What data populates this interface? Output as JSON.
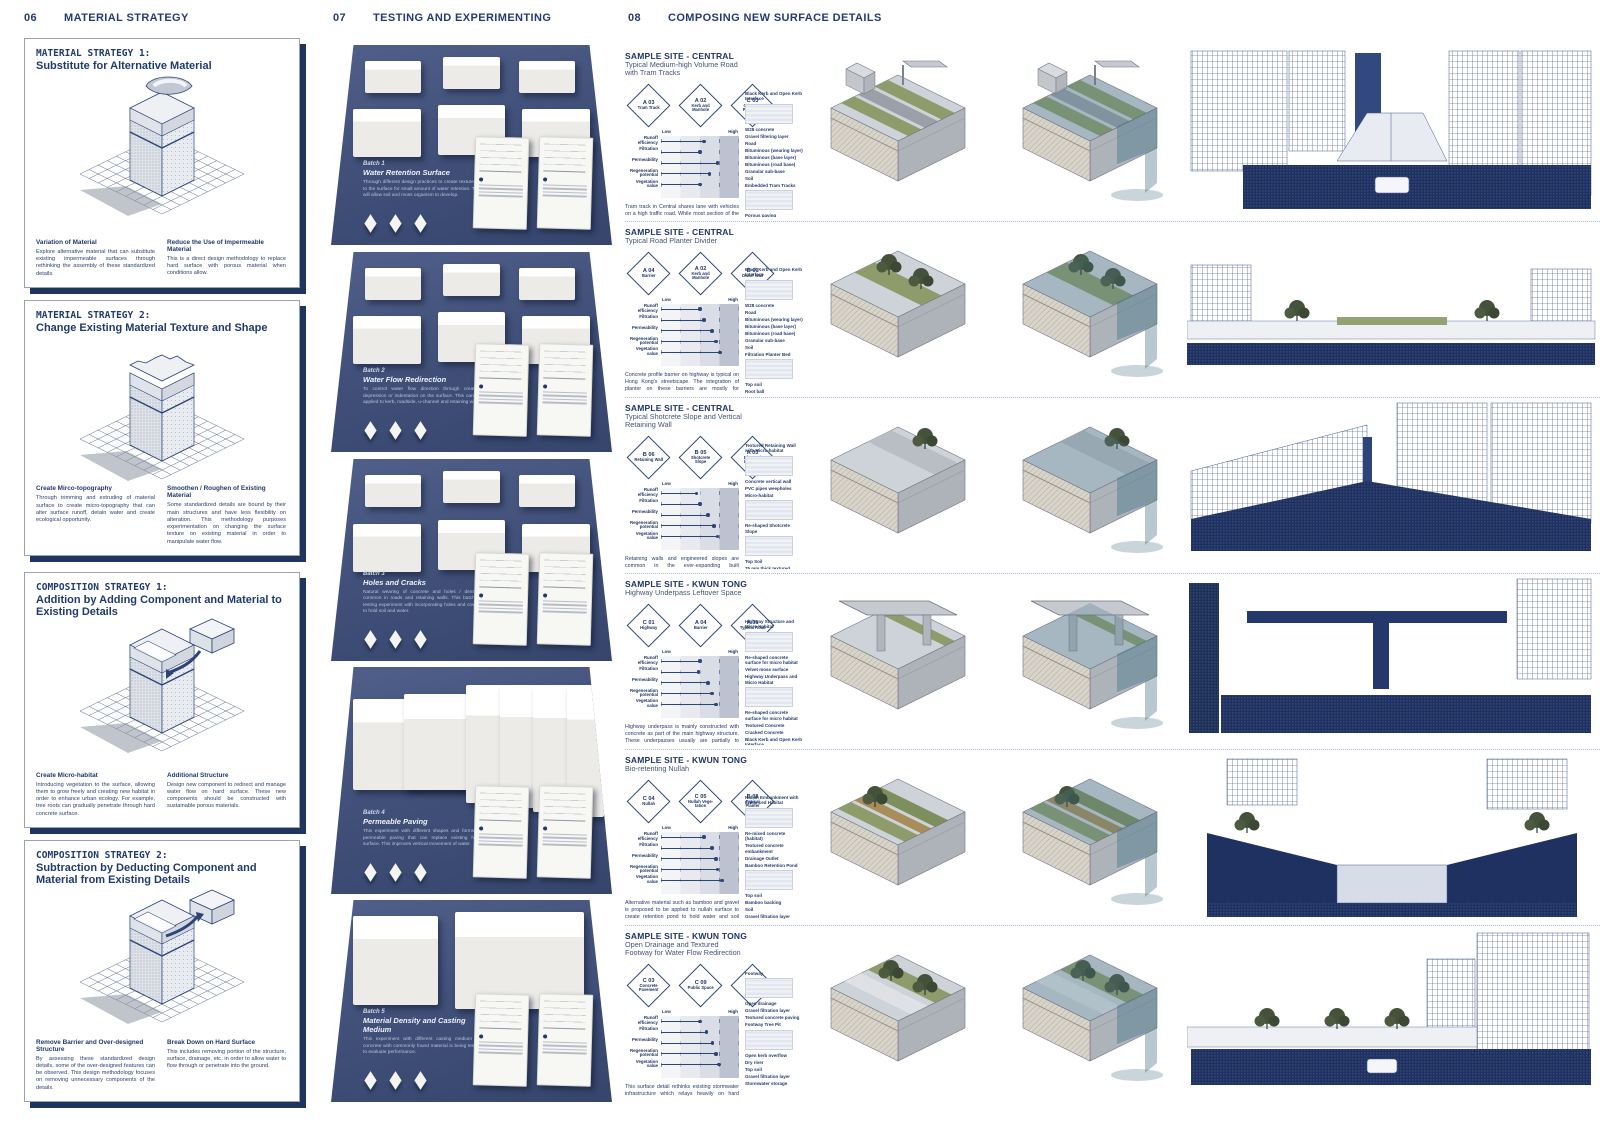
{
  "panels": [
    {
      "num": "06",
      "title": "MATERIAL STRATEGY"
    },
    {
      "num": "07",
      "title": "TESTING AND EXPERIMENTING"
    },
    {
      "num": "08",
      "title": "COMPOSING NEW SURFACE DETAILS"
    }
  ],
  "strategies": [
    {
      "kicker": "MATERIAL STRATEGY 1:",
      "title": "Substitute for Alternative Material",
      "left_heading": "Variation of Material",
      "left_body": "Explore alternative material that can substitute existing impermeable surfaces through rethinking the assembly of these standardized details.",
      "right_heading": "Reduce the Use of Impermeable Material",
      "right_body": "This is a direct design methodology to replace hard surface with porous material when conditions allow."
    },
    {
      "kicker": "MATERIAL STRATEGY 2:",
      "title": "Change Existing Material Texture and Shape",
      "left_heading": "Create Mirco-topography",
      "left_body": "Through trimming and extruding of material surface to create micro-topography that can alter surface runoff, detain water and create ecological opportunity.",
      "right_heading": "Smoothen / Roughen of Existing Material",
      "right_body": "Some standardized details are bound by their main structures and have less flexibility on alteration. This methodology purposes experimentation on changing the surface texture on existing material in order to manipulate water flow."
    },
    {
      "kicker": "COMPOSITION STRATEGY 1:",
      "title": "Addition by Adding Component and Material to Existing Details",
      "left_heading": "Create Micro-habitat",
      "left_body": "Introducing vegetation to the surface, allowing them to grow freely and creating new habitat in order to enhance urban ecology. For example, tree roots can gradually penetrate through hard concrete surface.",
      "right_heading": "Additional Structure",
      "right_body": "Design new component to redirect and manage water flow on hard surface. These new components should be constructed with sustainable porous materials."
    },
    {
      "kicker": "COMPOSITION STRATEGY 2:",
      "title": "Subtraction by Deducting Component and Material from Existing Details",
      "left_heading": "Remove Barrier and Over-designed Structure",
      "left_body": "By assessing these standardized design details, some of the over-designed features can be observed. This design methodology focuses on removing unnecessary components of the details.",
      "right_heading": "Break Down on Hard Surface",
      "right_body": "This includes removing portion of the structure, surface, drainage, etc. in order to allow water to flow through or penetrate into the ground."
    }
  ],
  "batches": [
    {
      "label": "Batch 1",
      "title": "Water Retention Surface",
      "body": "Through different design practices to create texture on to the surface for small amount of water retention. This will allow soil and moss organism to develop."
    },
    {
      "label": "Batch 2",
      "title": "Water Flow Redirection",
      "body": "To control water flow direction through creating depression or indentation on the surface. This can be applied to kerb, roadside, u-channel and retaining wall."
    },
    {
      "label": "Batch 3",
      "title": "Holes and Cracks",
      "body": "Natural wearing of concrete and holes / dent is common in roads and retaining walls. This batch is testing experiment with incorporating holes and cracks to hold soil and water."
    },
    {
      "label": "Batch 4",
      "title": "Permeable Paving",
      "body": "This experiment with different shapes and forms of permeable paving that can replace existing hard surface. This improves vertical movement of water."
    },
    {
      "label": "Batch 5",
      "title": "Material Density and Casting Medium",
      "body": "This experiment with different casting medium on concrete with commonly found material is being tested to evaluate performance."
    }
  ],
  "chart": {
    "low": "Low",
    "high": "High",
    "metrics": [
      "Runoff efficiency",
      "Filtration",
      "Permeability",
      "Regeneration potential",
      "Vegetation value"
    ]
  },
  "sites": [
    {
      "site": "SAMPLE SITE - CENTRAL",
      "subtitle": "Typical Medium-high Volume Road with Tram Tracks",
      "badges": [
        {
          "code": "A 03",
          "label": "Tram Track"
        },
        {
          "code": "A 02",
          "label": "Kerb and Manhole"
        },
        {
          "code": "C 03",
          "label": "Concrete Pavement"
        }
      ],
      "values": [
        0.55,
        0.5,
        0.72,
        0.62,
        0.5
      ],
      "body": "Tram track in Central shares lane with vehicles on a high traffic road. While most section of the road has been integrated with stormwater manholes to quickly drain off surface runoff, the low laying area still faces occasional flooding in heavy rainstorm. By removing traffic on tram track lane, it provides opportunity to reduce the surface area of the use of non-porous material.",
      "legend": [
        {
          "label": "Black Kerb and Open Kerb Interface",
          "swatch": true
        },
        {
          "label": "W28 concrete"
        },
        {
          "label": "Gravel filtering layer"
        },
        {
          "label": "Road"
        },
        {
          "label": "Bituminous (wearing layer)"
        },
        {
          "label": "Bituminous (base layer)"
        },
        {
          "label": "Bituminous (road base)"
        },
        {
          "label": "Granular sub-base"
        },
        {
          "label": "Soil"
        },
        {
          "label": "Embedded Tram Tracks",
          "swatch": true
        },
        {
          "label": "Porous paving"
        },
        {
          "label": "Top soil"
        },
        {
          "label": "Gravel filtering layer"
        }
      ]
    },
    {
      "site": "SAMPLE SITE - CENTRAL",
      "subtitle": "Typical Road Planter Divider",
      "badges": [
        {
          "code": "A 04",
          "label": "Barrier"
        },
        {
          "code": "A 02",
          "label": "Kerb and Manhole"
        },
        {
          "code": "B 01",
          "label": "Dwarf Wall"
        }
      ],
      "values": [
        0.5,
        0.55,
        0.65,
        0.7,
        0.75
      ],
      "body": "Concrete profile barrier on highway is typical on Hong Kong's streetscape. The integration of planter on these barriers are mostly for decoration use as illustration in detailed dissection A04. This new planter divider proposed to eliminate the raised profile to improve vertically porosity of surface runoff. Gravel filtration layer underneath can filtrate pollutants.",
      "legend": [
        {
          "label": "Black Kerb and Open Kerb Interface",
          "swatch": true
        },
        {
          "label": "W28 concrete"
        },
        {
          "label": "Road"
        },
        {
          "label": "Bituminous (wearing layer)"
        },
        {
          "label": "Bituminous (base layer)"
        },
        {
          "label": "Bituminous (road base)"
        },
        {
          "label": "Granular sub-base"
        },
        {
          "label": "Soil"
        },
        {
          "label": "Filtration Planter Bed",
          "swatch": true
        },
        {
          "label": "Top soil"
        },
        {
          "label": "Root ball"
        },
        {
          "label": "Compacted fill"
        },
        {
          "label": "Plant base"
        }
      ]
    },
    {
      "site": "SAMPLE SITE - CENTRAL",
      "subtitle": "Typical Shotcrete Slope and Vertical Retaining Wall",
      "badges": [
        {
          "code": "B 06",
          "label": "Retaining Wall"
        },
        {
          "code": "B 05",
          "label": "Shotcrete Slope"
        },
        {
          "code": "A 03",
          "label": "Diagonal Profiling"
        }
      ],
      "values": [
        0.45,
        0.5,
        0.6,
        0.68,
        0.72
      ],
      "body": "Retaining walls and engineered slopes are common in the ever-expanding built environment on urban fringe. While structurally these walls and slopes are limited by its ability to hold soil stably, the surface texture and shape can be altered to create holes and dents to hold water and soil for organism enhancing ecology on a desolate surface of hard concrete.",
      "legend": [
        {
          "label": "Textured Retaining Wall with Micro-habitat",
          "swatch": true
        },
        {
          "label": "Concrete vertical wall"
        },
        {
          "label": "PVC pipes weepholes"
        },
        {
          "label": "Micro-habitat",
          "swatch": true
        },
        {
          "label": "Re-shaped Shotcrete Slope",
          "swatch": true
        },
        {
          "label": "Top Soil"
        },
        {
          "label": "75 mm thick textured shotcrete"
        },
        {
          "label": "Slope face"
        }
      ]
    },
    {
      "site": "SAMPLE SITE - KWUN TONG",
      "subtitle": "Highway Underpass Leftover Space",
      "badges": [
        {
          "code": "C 01",
          "label": "Highway"
        },
        {
          "code": "A 04",
          "label": "Barrier"
        },
        {
          "code": "A 01",
          "label": "Typical Road"
        }
      ],
      "values": [
        0.5,
        0.48,
        0.6,
        0.65,
        0.7
      ],
      "body": "Highway underpass is mainly constructed with concrete as part of the main highway structure. These underpasses usually are partially to entirely shaded with limited access. With minor alteration introduced to the concrete surface, micro habitat and moss can strive in these leftover spaces. This surface details explore different surfaces' ability to hold soil and water, for vegetation growth.",
      "legend": [
        {
          "label": "Highway Structure and Micro Habitat",
          "swatch": true
        },
        {
          "label": "Re-shaped concrete surface for micro habitat"
        },
        {
          "label": "Velvet moss surface"
        },
        {
          "label": "Highway Underpass and Micro Habitat",
          "swatch": true
        },
        {
          "label": "Re-shaped concrete surface for micro habitat"
        },
        {
          "label": "Textured Concrete"
        },
        {
          "label": "Cracked Concrete"
        },
        {
          "label": "Black Kerb and Open Kerb Interface"
        },
        {
          "label": "W28 concrete"
        }
      ]
    },
    {
      "site": "SAMPLE SITE - KWUN TONG",
      "subtitle": "Bio-retenting Nullah",
      "badges": [
        {
          "code": "C 04",
          "label": "Nullah"
        },
        {
          "code": "C 05",
          "label": "Nullah Vege- tation"
        },
        {
          "code": "B 08",
          "label": "Typical Planter"
        }
      ],
      "values": [
        0.55,
        0.65,
        0.7,
        0.72,
        0.78
      ],
      "body": "Alternative material such as bamboo and gravel is proposed to be applied to nullah surface to create retention pond to hold water and soil during dry season. This will enhance its ecology and provide habitats in additional to the current hard concrete surface. The gravel filtering layer and diverse vegetation and filter and treat water before reuse.",
      "legend": [
        {
          "label": "Nullah Embankment with Enhanced Habitat",
          "swatch": true
        },
        {
          "label": "Re-mixed concrete (habitat)"
        },
        {
          "label": "Textured concrete embankment"
        },
        {
          "label": "Drainage Outlet"
        },
        {
          "label": "Bamboo Retention Pond",
          "swatch": true
        },
        {
          "label": "Top soil"
        },
        {
          "label": "Bamboo backing"
        },
        {
          "label": "Soil"
        },
        {
          "label": "Gravel filtration layer"
        }
      ]
    },
    {
      "site": "SAMPLE SITE - KWUN TONG",
      "subtitle": "Open Drainage and Textured Footway for Water Flow Redirection",
      "badges": [
        {
          "code": "C 03",
          "label": "Concrete Pavement"
        },
        {
          "code": "C 09",
          "label": "Public Space"
        },
        {
          "code": "B 09",
          "label": "Planter"
        }
      ],
      "values": [
        0.5,
        0.58,
        0.66,
        0.7,
        0.74
      ],
      "body": "This surface detail rethinks existing stormwater infrastructure which relays heavily on hard engineering such as pipes, manholes and channels. Surface texture and shape can be manipulated to alter the water flow direction. Open drainage and kerb-less planter can allow surface runoff to infiltrate, recharging groundwater or collecting water for reuse.",
      "legend": [
        {
          "label": "Footway",
          "swatch": true
        },
        {
          "label": "Open drainage"
        },
        {
          "label": "Gravel filtration layer"
        },
        {
          "label": "Textured concrete paving"
        },
        {
          "label": "Footway Tree Pit",
          "swatch": true
        },
        {
          "label": "Open kerb overflow"
        },
        {
          "label": "Dry river"
        },
        {
          "label": "Top soil"
        },
        {
          "label": "Gravel filtration layer"
        },
        {
          "label": "Stormwater storage"
        }
      ]
    }
  ],
  "colors": {
    "accent": "#1f355f",
    "photo_bg": "#41517a",
    "ink": "#22386b",
    "dark_band": "#1f3160"
  }
}
